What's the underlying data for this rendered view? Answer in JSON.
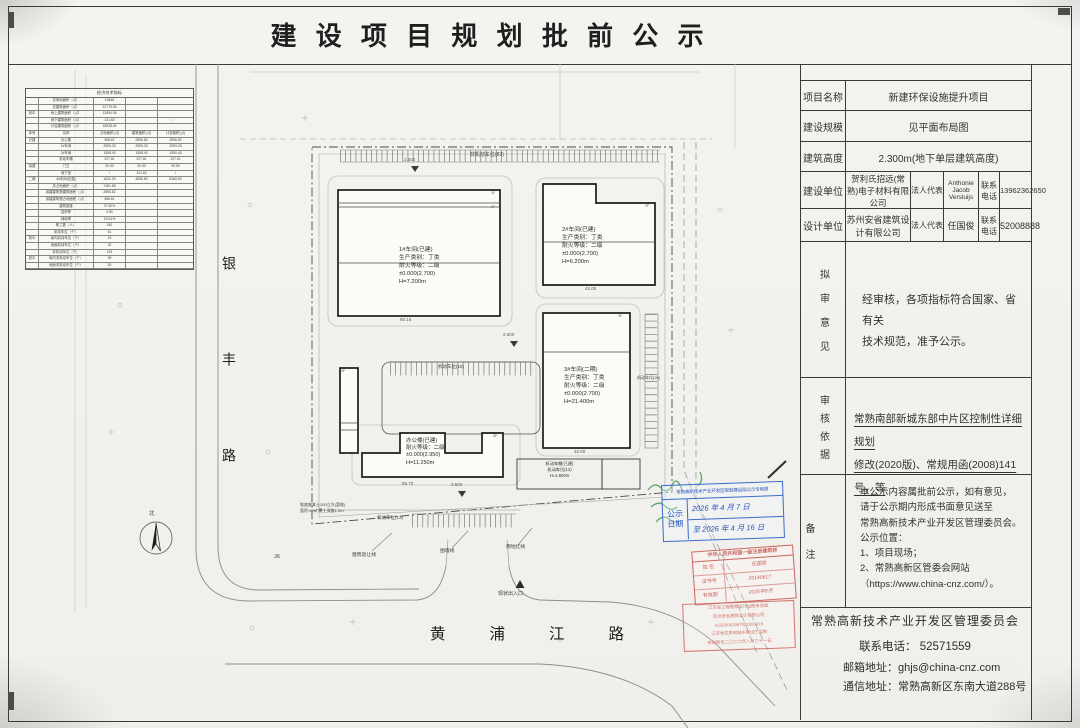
{
  "title": "建 设 项 目 规 划 批 前 公 示",
  "info": {
    "project": {
      "label": "项目名称",
      "value": "新建环保设施提升项目"
    },
    "scale": {
      "label": "建设规模",
      "value": "见平面布局图"
    },
    "height": {
      "label": "建筑高度",
      "value": "2.300m(地下单层建筑高度)"
    },
    "builder": {
      "label": "建设单位",
      "company": "贺利氏招远(常熟)电子材料有限公司",
      "rep_label": "法人代表",
      "rep": "Anthonie Jacob Versluijs",
      "tel_label": "联系电话",
      "tel": "13962362650"
    },
    "designer": {
      "label": "设计单位",
      "company": "苏州安省建筑设计有限公司",
      "rep_label": "法人代表",
      "rep": "任国俊",
      "tel_label": "联系电话",
      "tel": "52008888"
    },
    "opinion": {
      "label": "拟审意见",
      "line1": "经审核，各项指标符合国家、省有关",
      "line2": "技术规范，准予公示。"
    },
    "basis": {
      "label": "审核依据",
      "line1": "常熟南部新城东部中片区控制性详细规划",
      "line2": "修改(2020版)、常规用函(2008)141号，等"
    },
    "notes": {
      "label": "备注",
      "lines": [
        "本公示内容属批前公示，如有意见，",
        "请于公示期内形成书面意见送至",
        "常熟高新技术产业开发区管理委员会。",
        "公示位置：",
        "1、项目现场；",
        "2、常熟高新区管委会网站",
        "（https://www.china-cnz.com/）。"
      ]
    }
  },
  "footer": {
    "org": "常熟高新技术产业开发区管理委员会",
    "tel": "联系电话：  52571559",
    "email": "邮箱地址：ghjs@china-cnz.com",
    "address": "通信地址：常熟高新区东南大道288号"
  },
  "econ": {
    "title": "经济技术指标",
    "rows": [
      [
        "",
        "总用地面积（㎡）",
        "19848",
        "",
        ""
      ],
      [
        "",
        "总建筑面积（㎡）",
        "12775.06",
        "",
        ""
      ],
      [
        "其中",
        "地上建筑面积（㎡）",
        "12654.06",
        "",
        ""
      ],
      [
        "",
        "地下建筑面积（㎡）",
        "121.60",
        "",
        ""
      ],
      [
        "",
        "计容建筑面积（㎡）",
        "15928.06",
        "",
        ""
      ],
      [
        "序号",
        "名称",
        "占地面积(㎡)",
        "建筑面积(㎡)",
        "计容面积(㎡)"
      ],
      [
        "已建",
        "办公楼",
        "968.61",
        "2896.82",
        "2896.82"
      ],
      [
        "",
        "1#车间",
        "2993.33",
        "2993.33",
        "2993.33"
      ],
      [
        "",
        "2#车间",
        "1558.40",
        "1558.40",
        "1550.40"
      ],
      [
        "",
        "机动车棚",
        "227.81",
        "227.81",
        "227.01"
      ],
      [
        "拟建",
        "门卫",
        "90.50",
        "90.50",
        "90.50"
      ],
      [
        "",
        "地下室",
        "/",
        "121.60",
        "/"
      ],
      [
        "二期",
        "3#车间(在建)",
        "1632.00",
        "4898.80",
        "8160.00"
      ],
      [
        "",
        "总占地面积（㎡）",
        "7461.85",
        "",
        ""
      ],
      [
        "",
        "拟建建筑物建筑面积（㎡）",
        "2896.82",
        "",
        ""
      ],
      [
        "",
        "拟建建筑物占地面积（㎡）",
        "968.61",
        "",
        ""
      ],
      [
        "",
        "建筑密度",
        "37.60%",
        "",
        ""
      ],
      [
        "",
        "容积率",
        "0.80",
        "",
        ""
      ],
      [
        "",
        "绿地率",
        "19.61%",
        "",
        ""
      ],
      [
        "",
        "职工数（人）",
        "160",
        "",
        ""
      ],
      [
        "",
        "机动车位（个）",
        "61",
        "",
        ""
      ],
      [
        "其中",
        "库内机动车位（个）",
        "29",
        "",
        ""
      ],
      [
        "",
        "地面机动车位（个）",
        "32",
        "",
        ""
      ],
      [
        "",
        "非机动车位（个）",
        "125",
        "",
        ""
      ],
      [
        "其中",
        "库内非机动车位（个）",
        "95",
        "",
        ""
      ],
      [
        "",
        "地面非机动车位（个）",
        "30",
        "",
        ""
      ]
    ]
  },
  "plan": {
    "roads": {
      "left": "银丰路",
      "bottom": "黄浦江路"
    },
    "buildings": {
      "b1": [
        "1#车间(已建)",
        "生产类别：丁类",
        "耐火等级：二级",
        "±0.000(2.700)",
        "H=7.200m"
      ],
      "b2": [
        "2#车间(已建)",
        "生产类别：丁类",
        "耐火等级：二级",
        "±0.000(2.700)",
        "H=6.200m"
      ],
      "b3": [
        "3#车间(二期)",
        "生产类别：丁类",
        "耐火等级：二级",
        "±0.000(2.700)",
        "H=21.400m"
      ],
      "office": [
        "办公楼(已建)",
        "耐火等级：二级",
        "±0.000(2.950)",
        "H=11.250m"
      ],
      "carport": [
        "机动车棚(已建)",
        "机动车位(12)",
        "H=2.800m"
      ]
    },
    "parking": {
      "top": "非机动车位(83)",
      "mid": "机动车位(18)",
      "right": "机动车位(26)",
      "bottom": "机动车位(13)"
    },
    "labels": {
      "entrance": "现状出入口",
      "setback": "建筑退让线",
      "wall": "围墙线",
      "redline": "用地红线",
      "j6": "J6",
      "soil1": "堆放废弃土200立方(暂堆)",
      "soil2": "面积:90㎡ 覆土深度1.2m",
      "north": "北"
    },
    "dims": {
      "b1": "60.16",
      "b2": "42.00",
      "b3": "32.00",
      "office": "65.70",
      "elev": "2.500"
    },
    "floor_marks": {
      "b1a": "1F",
      "b1b": "1F",
      "b2": "2F",
      "b3": "3F",
      "office": "3F",
      "tower": "3F"
    }
  },
  "stamps": {
    "blue": {
      "header": "常熟高新技术产业开发区规划建设局公示专用章",
      "label1": "公示",
      "label2": "日期",
      "from": "2026 年 4 月 7 日",
      "to": "至 2026 年 4 月 16 日"
    },
    "red_cert": {
      "title": "中华人民共和国一级注册建筑师",
      "rows": [
        [
          "姓  名",
          "任国俊"
        ],
        [
          "证书号",
          "20140617"
        ],
        [
          "有效期",
          "2026年8月"
        ]
      ]
    },
    "red_seal": {
      "lines": [
        "江苏省工程勘察设计出图专用章",
        "苏州安省建筑设计有限公司",
        "A1500082967001000416",
        "江苏省住房和城乡建设厅监制",
        "有效期至二〇二六年八月三十一日"
      ]
    }
  }
}
